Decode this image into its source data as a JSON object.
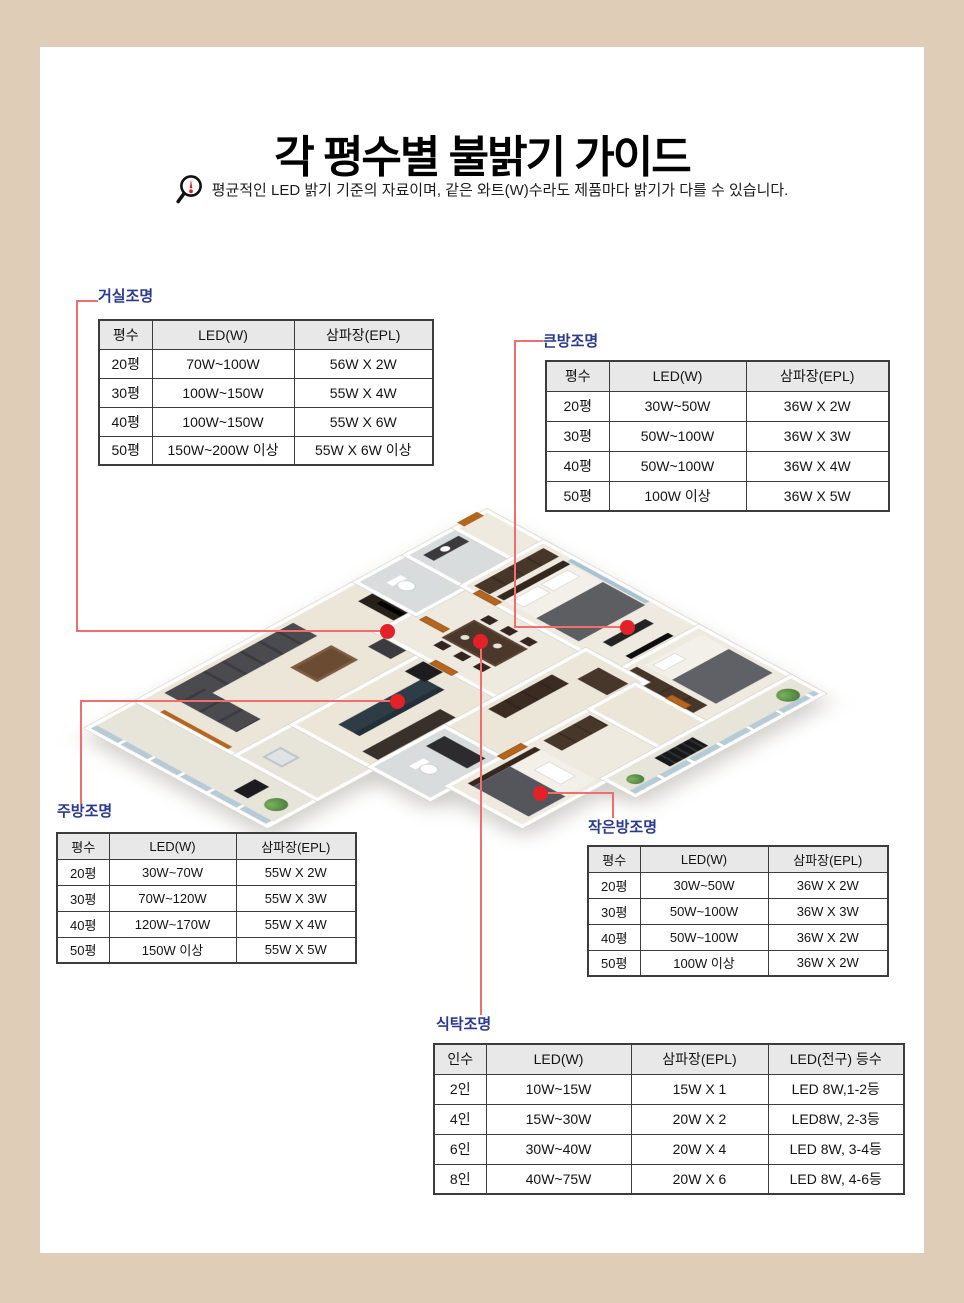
{
  "page": {
    "title": "각 평수별 불밝기 가이드",
    "notice": "평균적인 LED 밝기 기준의 자료이며, 같은 와트(W)수라도 제품마다 밝기가 다를 수 있습니다."
  },
  "colors": {
    "frame_beige": "#e0cdb8",
    "label_blue": "#2b3990",
    "connector_red": "#f26d6d",
    "marker_red": "#e32128",
    "table_header_gray": "#e8e8e8"
  },
  "tables": {
    "living": {
      "label": "거실조명",
      "headers": [
        "평수",
        "LED(W)",
        "삼파장(EPL)"
      ],
      "rows": [
        [
          "20평",
          "70W~100W",
          "56W X 2W"
        ],
        [
          "30평",
          "100W~150W",
          "55W X 4W"
        ],
        [
          "40평",
          "100W~150W",
          "55W X 6W"
        ],
        [
          "50평",
          "150W~200W 이상",
          "55W X 6W 이상"
        ]
      ]
    },
    "big_room": {
      "label": "큰방조명",
      "headers": [
        "평수",
        "LED(W)",
        "삼파장(EPL)"
      ],
      "rows": [
        [
          "20평",
          "30W~50W",
          "36W X 2W"
        ],
        [
          "30평",
          "50W~100W",
          "36W X 3W"
        ],
        [
          "40평",
          "50W~100W",
          "36W X 4W"
        ],
        [
          "50평",
          "100W 이상",
          "36W X 5W"
        ]
      ]
    },
    "kitchen": {
      "label": "주방조명",
      "headers": [
        "평수",
        "LED(W)",
        "삼파장(EPL)"
      ],
      "rows": [
        [
          "20평",
          "30W~70W",
          "55W X 2W"
        ],
        [
          "30평",
          "70W~120W",
          "55W X 3W"
        ],
        [
          "40평",
          "120W~170W",
          "55W X 4W"
        ],
        [
          "50평",
          "150W 이상",
          "55W X 5W"
        ]
      ]
    },
    "small_room": {
      "label": "작은방조명",
      "headers": [
        "평수",
        "LED(W)",
        "삼파장(EPL)"
      ],
      "rows": [
        [
          "20평",
          "30W~50W",
          "36W X 2W"
        ],
        [
          "30평",
          "50W~100W",
          "36W X 3W"
        ],
        [
          "40평",
          "50W~100W",
          "36W X 2W"
        ],
        [
          "50평",
          "100W 이상",
          "36W X 2W"
        ]
      ]
    },
    "dining": {
      "label": "식탁조명",
      "headers": [
        "인수",
        "LED(W)",
        "삼파장(EPL)",
        "LED(전구) 등수"
      ],
      "rows": [
        [
          "2인",
          "10W~15W",
          "15W X 1",
          "LED 8W,1-2등"
        ],
        [
          "4인",
          "15W~30W",
          "20W X 2",
          "LED8W, 2-3등"
        ],
        [
          "6인",
          "30W~40W",
          "20W X 4",
          "LED 8W, 3-4등"
        ],
        [
          "8인",
          "40W~75W",
          "20W X 6",
          "LED 8W, 4-6등"
        ]
      ]
    }
  }
}
